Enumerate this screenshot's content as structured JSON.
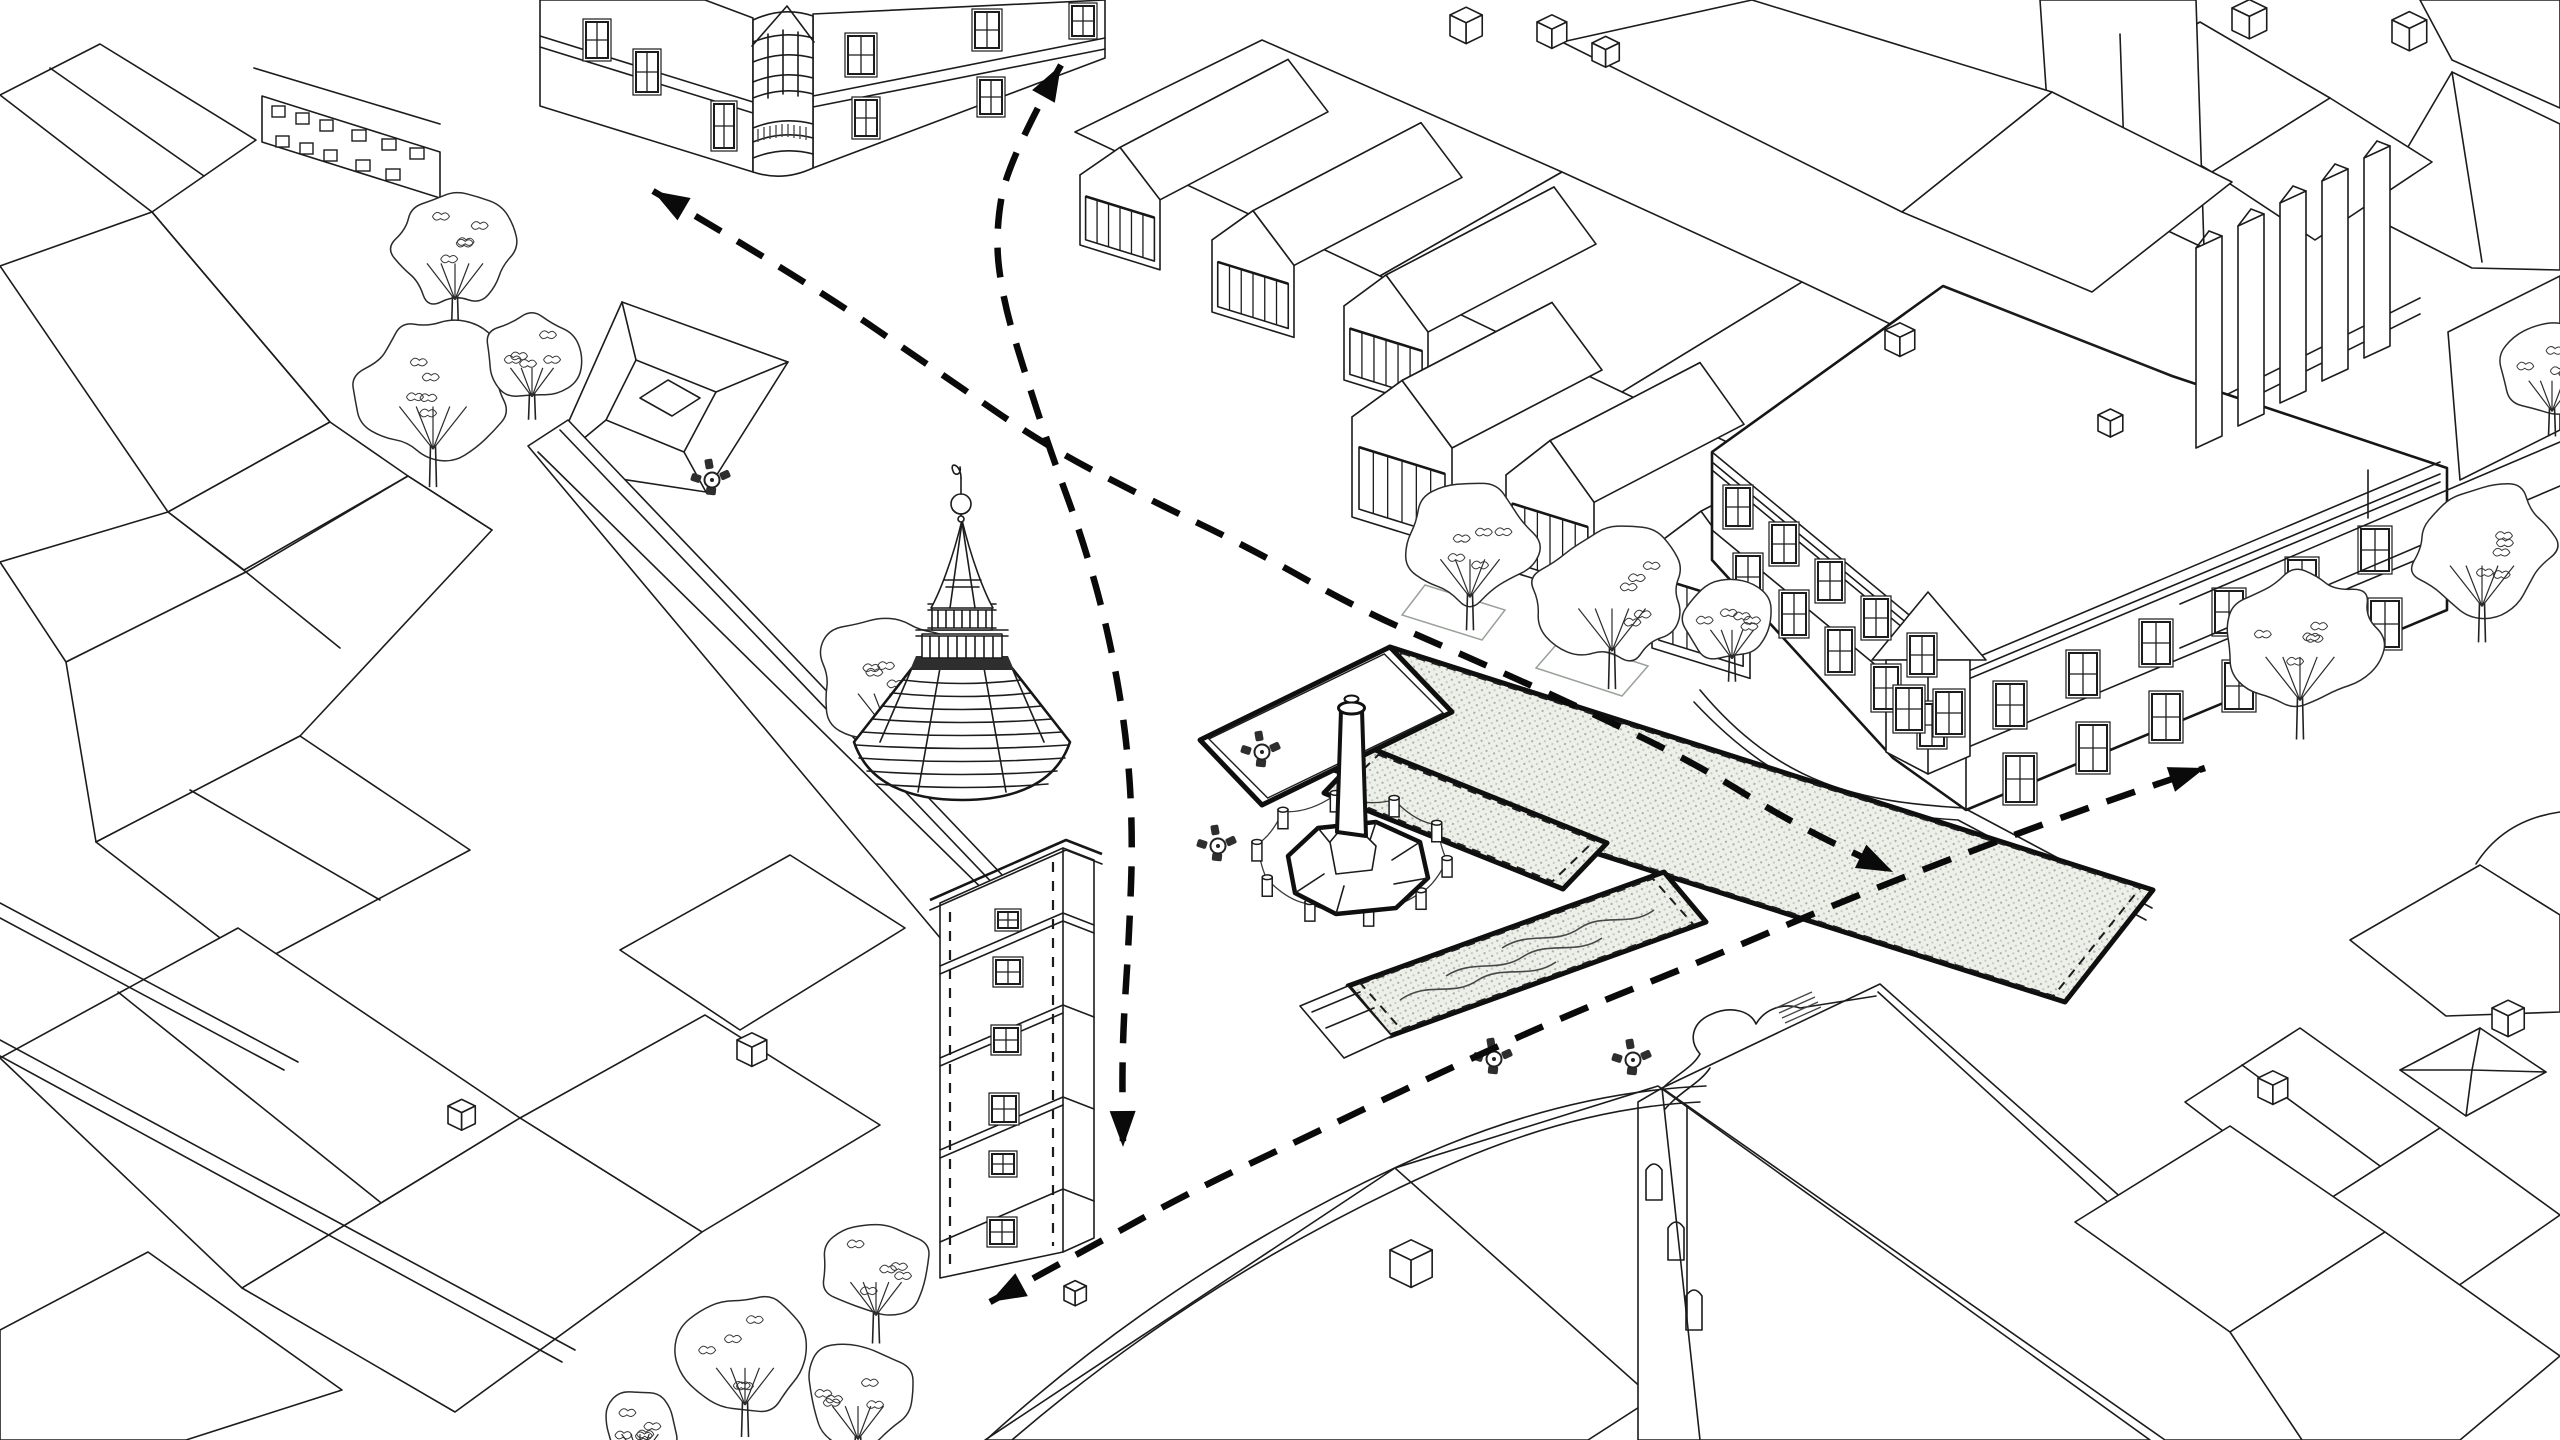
{
  "scene": {
    "width": 2560,
    "height": 1440,
    "background": "#ffffff",
    "line_color": "#1c1c1c",
    "bold_color": "#0f0f0f",
    "route_color": "#0a0a0a",
    "hatch_fill": "#edefe9",
    "hatch_dot": "#a9afa7",
    "dark_band": "#2e2e2e",
    "furniture_color": "#2e2e2e",
    "route_dash": "30 19",
    "route_width": 6.5
  },
  "routes": [
    {
      "id": "route-northwest-across-square",
      "arrow_start": true,
      "arrow_end": true,
      "points": [
        [
          653,
          191
        ],
        [
          800,
          277
        ],
        [
          950,
          380
        ],
        [
          1046,
          446
        ],
        [
          1150,
          500
        ],
        [
          1250,
          548
        ],
        [
          1360,
          610
        ],
        [
          1470,
          658
        ],
        [
          1590,
          712
        ],
        [
          1700,
          766
        ],
        [
          1790,
          822
        ],
        [
          1893,
          872
        ]
      ]
    },
    {
      "id": "route-north-south-past-tower",
      "arrow_start": true,
      "arrow_end": true,
      "points": [
        [
          1061,
          65
        ],
        [
          1008,
          160
        ],
        [
          995,
          235
        ],
        [
          1003,
          300
        ],
        [
          1024,
          370
        ],
        [
          1050,
          450
        ],
        [
          1083,
          540
        ],
        [
          1108,
          630
        ],
        [
          1126,
          730
        ],
        [
          1133,
          830
        ],
        [
          1129,
          940
        ],
        [
          1122,
          1045
        ],
        [
          1123,
          1147
        ]
      ]
    },
    {
      "id": "route-southwest-to-east-street",
      "arrow_start": true,
      "arrow_end": true,
      "points": [
        [
          990,
          1302
        ],
        [
          1085,
          1250
        ],
        [
          1190,
          1192
        ],
        [
          1300,
          1140
        ],
        [
          1420,
          1082
        ],
        [
          1560,
          1018
        ],
        [
          1700,
          962
        ],
        [
          1850,
          898
        ],
        [
          2000,
          840
        ],
        [
          2110,
          800
        ],
        [
          2205,
          768
        ]
      ]
    }
  ],
  "plaza": {
    "platform": {
      "quad": [
        [
          1200,
          740
        ],
        [
          1390,
          647
        ],
        [
          1452,
          712
        ],
        [
          1262,
          805
        ]
      ]
    },
    "beds": [
      {
        "id": "planting-bed-upper",
        "quad": [
          [
            1390,
            647
          ],
          [
            2153,
            890
          ],
          [
            2065,
            1002
          ],
          [
            1302,
            760
          ]
        ]
      },
      {
        "id": "planting-bed-middle",
        "quad": [
          [
            1368,
            747
          ],
          [
            1607,
            843
          ],
          [
            1563,
            889
          ],
          [
            1324,
            793
          ]
        ]
      },
      {
        "id": "water-garden-bed",
        "quad": [
          [
            1348,
            986
          ],
          [
            1664,
            872
          ],
          [
            1706,
            922
          ],
          [
            1390,
            1036
          ]
        ]
      }
    ],
    "steps": {
      "poly": [
        [
          1300,
          1006
        ],
        [
          1348,
          986
        ],
        [
          1392,
          1036
        ],
        [
          1344,
          1058
        ]
      ],
      "lines": [
        [
          [
            1312,
            1012
          ],
          [
            1360,
            992
          ]
        ],
        [
          [
            1326,
            1028
          ],
          [
            1374,
            1008
          ]
        ]
      ]
    },
    "waves": [
      "M1400,1000 C1428,980 1452,998 1478,980 C1504,964 1530,980 1556,962",
      "M1446,976 C1474,958 1498,974 1524,956 C1550,940 1576,956 1602,938",
      "M1502,948 C1530,930 1554,946 1580,928 C1604,912 1630,928 1654,910"
    ],
    "monument": {
      "shaft_poly": [
        [
          1341,
          710
        ],
        [
          1362,
          710
        ],
        [
          1366,
          836
        ],
        [
          1337,
          832
        ]
      ],
      "cap": [
        1351.5,
        708,
        13,
        6
      ],
      "knob": [
        1351.5,
        699,
        7,
        3.5
      ],
      "base": [
        [
          1288,
          856
        ],
        [
          1318,
          828
        ],
        [
          1376,
          822
        ],
        [
          1420,
          842
        ],
        [
          1428,
          878
        ],
        [
          1396,
          908
        ],
        [
          1336,
          914
        ],
        [
          1295,
          893
        ]
      ],
      "pedestal": [
        [
          1330,
          842
        ],
        [
          1340,
          830
        ],
        [
          1364,
          834
        ],
        [
          1376,
          846
        ],
        [
          1372,
          870
        ],
        [
          1336,
          874
        ]
      ],
      "base_lines": "M1318,828 L1336,850 M1376,822 L1368,846 M1420,842 L1392,860 M1295,893 L1324,874 M1428,878 L1394,884 M1336,914 L1344,886"
    },
    "bollards": {
      "center": [
        1352,
        868
      ],
      "rx": 96,
      "ry": 58,
      "count": 10,
      "start_deg": 8
    }
  },
  "trees": [
    {
      "p": [
        455,
        248,
        70
      ],
      "layer": "back"
    },
    {
      "p": [
        433,
        388,
        84
      ],
      "layer": "back"
    },
    {
      "p": [
        532,
        356,
        54
      ],
      "layer": "back"
    },
    {
      "p": [
        890,
        676,
        80
      ],
      "layer": "back"
    },
    {
      "p": [
        876,
        1268,
        64
      ],
      "layer": "front"
    },
    {
      "p": [
        745,
        1352,
        72
      ],
      "layer": "front"
    },
    {
      "p": [
        858,
        1392,
        64
      ],
      "layer": "front"
    },
    {
      "p": [
        640,
        1424,
        46
      ],
      "layer": "front"
    },
    {
      "p": [
        1470,
        543,
        74
      ],
      "layer": "front"
    },
    {
      "p": [
        1612,
        590,
        84
      ],
      "layer": "front"
    },
    {
      "p": [
        1732,
        618,
        54
      ],
      "layer": "front"
    },
    {
      "p": [
        2300,
        638,
        86
      ],
      "layer": "front"
    },
    {
      "p": [
        2482,
        548,
        80
      ],
      "layer": "front"
    },
    {
      "p": [
        2552,
        368,
        58
      ],
      "layer": "front"
    }
  ],
  "planters": [
    [
      [
        1425,
        585
      ],
      [
        1505,
        610
      ],
      [
        1482,
        640
      ],
      [
        1402,
        615
      ]
    ],
    [
      [
        1562,
        638
      ],
      [
        1648,
        666
      ],
      [
        1622,
        696
      ],
      [
        1536,
        668
      ]
    ]
  ],
  "cafe_tables": [
    [
      712,
      480
    ],
    [
      1262,
      752
    ],
    [
      1218,
      846
    ],
    [
      1494,
      1059
    ],
    [
      1633,
      1060
    ]
  ],
  "cubes": [
    [
      1450,
      15,
      26
    ],
    [
      1537,
      22,
      24
    ],
    [
      1592,
      43,
      22
    ],
    [
      2232,
      8,
      28
    ],
    [
      2392,
      20,
      28
    ],
    [
      448,
      1106,
      22
    ],
    [
      737,
      1040,
      24
    ],
    [
      1064,
      1286,
      18
    ],
    [
      1390,
      1250,
      34
    ],
    [
      2258,
      1078,
      24
    ],
    [
      2492,
      1008,
      26
    ],
    [
      1885,
      330,
      24
    ],
    [
      2098,
      415,
      20
    ]
  ],
  "slabs": {
    "list": [
      [
        2196,
        248
      ],
      [
        2238,
        226
      ],
      [
        2280,
        203
      ],
      [
        2322,
        181
      ],
      [
        2364,
        158
      ]
    ],
    "w": 26,
    "h": 200
  },
  "modern_modules": {
    "slope": 0.31,
    "rear": {
      "roof_vec": [
        168,
        -88
      ],
      "items": [
        {
          "bl": [
            1080,
            245
          ],
          "w": 80,
          "wallH": 70,
          "apexH": 40
        },
        {
          "bl": [
            1212,
            312
          ],
          "w": 82,
          "wallH": 72,
          "apexH": 42
        },
        {
          "bl": [
            1344,
            380
          ],
          "w": 84,
          "wallH": 74,
          "apexH": 44
        }
      ]
    },
    "front": {
      "roof_vec": [
        150,
        -78
      ],
      "items": [
        {
          "bl": [
            1352,
            517
          ],
          "w": 100,
          "wallH": 100,
          "apexH": 52
        },
        {
          "bl": [
            1506,
            570
          ],
          "w": 88,
          "wallH": 95,
          "apexH": 48
        },
        {
          "bl": [
            1652,
            648
          ],
          "w": 98,
          "wallH": 100,
          "apexH": 52
        }
      ]
    },
    "mullions": 5
  },
  "historic_windows": {
    "rows": [
      {
        "start": [
          1726,
          488
        ],
        "step": [
          46,
          37
        ],
        "n": 5,
        "size": [
          24,
          38
        ]
      },
      {
        "start": [
          1736,
          556
        ],
        "step": [
          46,
          37
        ],
        "n": 5,
        "size": [
          24,
          42
        ]
      },
      {
        "start": [
          1996,
          684
        ],
        "step": [
          73,
          -31
        ],
        "n": 6,
        "size": [
          28,
          42
        ]
      },
      {
        "start": [
          2006,
          756
        ],
        "step": [
          73,
          -31
        ],
        "n": 6,
        "size": [
          28,
          46
        ]
      }
    ],
    "extra": [
      [
        1896,
        688,
        26,
        42
      ],
      [
        1936,
        692,
        26,
        42
      ]
    ]
  },
  "tower_windows": [
    [
      998,
      912,
      20,
      16
    ],
    [
      996,
      960,
      24,
      24
    ],
    [
      994,
      1028,
      24,
      24
    ],
    [
      992,
      1096,
      24,
      26
    ],
    [
      992,
      1154,
      22,
      20
    ],
    [
      990,
      1220,
      24,
      24
    ]
  ],
  "tower_ribs": [
    [
      680,
      59
    ],
    [
      693,
      69
    ],
    [
      706,
      80
    ],
    [
      719,
      90
    ],
    [
      732,
      100
    ],
    [
      745,
      106
    ],
    [
      758,
      103
    ],
    [
      771,
      95
    ],
    [
      784,
      86
    ]
  ],
  "corner_windows": [
    [
      586,
      22,
      22,
      36
    ],
    [
      636,
      52,
      22,
      40
    ],
    [
      714,
      104,
      20,
      44
    ],
    [
      848,
      36,
      26,
      38
    ],
    [
      975,
      12,
      24,
      36
    ],
    [
      855,
      100,
      22,
      36
    ],
    [
      980,
      80,
      22,
      34
    ],
    [
      1072,
      6,
      22,
      30
    ]
  ],
  "small_facade_windows": [
    [
      272,
      106,
      13,
      11
    ],
    [
      296,
      113,
      13,
      11
    ],
    [
      320,
      120,
      13,
      11
    ],
    [
      352,
      130,
      14,
      11
    ],
    [
      382,
      139,
      14,
      11
    ],
    [
      410,
      148,
      14,
      11
    ],
    [
      276,
      136,
      13,
      11
    ],
    [
      300,
      143,
      13,
      11
    ],
    [
      324,
      150,
      13,
      11
    ],
    [
      356,
      160,
      14,
      11
    ],
    [
      386,
      169,
      14,
      11
    ]
  ]
}
